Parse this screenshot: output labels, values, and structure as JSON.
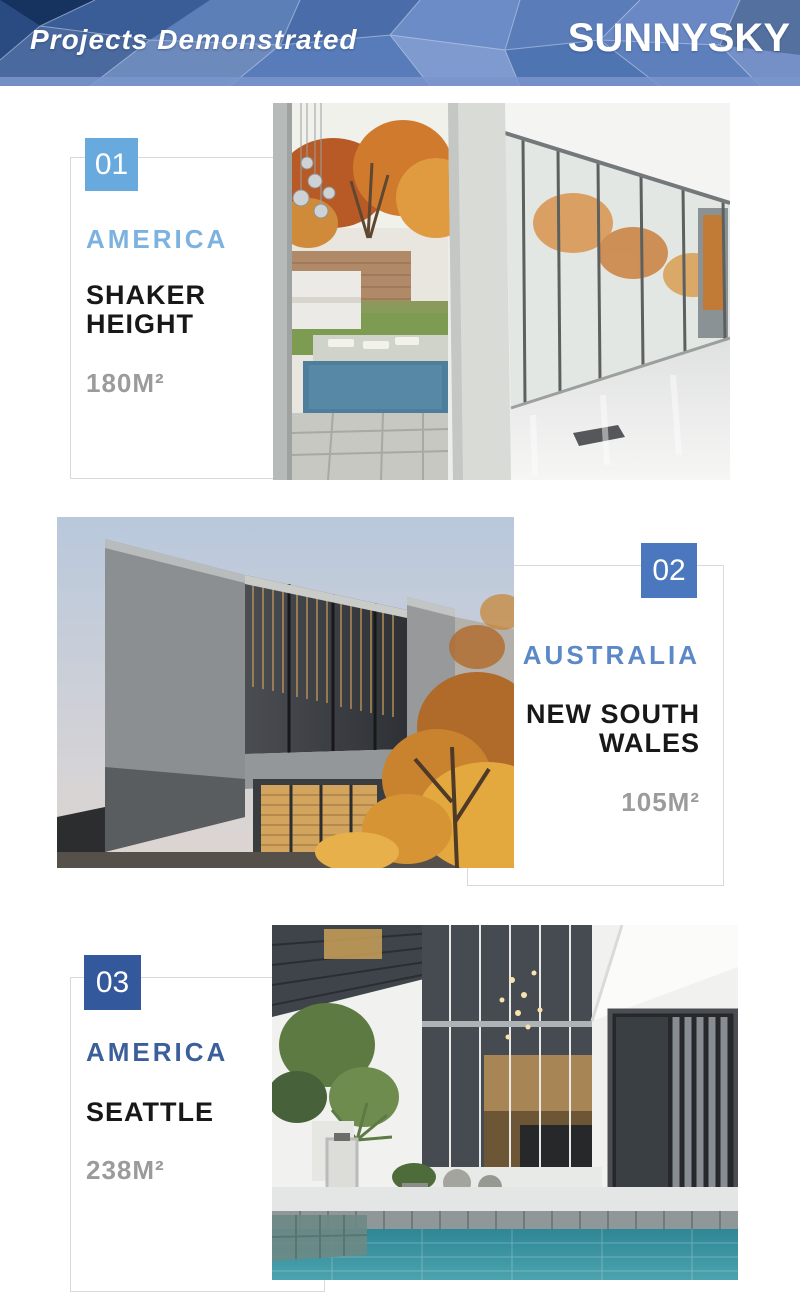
{
  "header": {
    "title": "Projects Demonstrated",
    "brand": "SUNNYSKY"
  },
  "projects": [
    {
      "number": "01",
      "country": "AMERICA",
      "location": "SHAKER HEIGHT",
      "area": "180M²",
      "badge_color": "#68aade",
      "country_color": "#7cb2df",
      "photo": "glass-house-autumn-corridor-photo"
    },
    {
      "number": "02",
      "country": "AUSTRALIA",
      "location": "NEW SOUTH WALES",
      "area": "105M²",
      "badge_color": "#4a77bd",
      "country_color": "#5b88c6",
      "photo": "modern-house-dusk-photo"
    },
    {
      "number": "03",
      "country": "AMERICA",
      "location": "SEATTLE",
      "area": "238M²",
      "badge_color": "#33589b",
      "country_color": "#3b5f9a",
      "photo": "courtyard-pool-house-photo"
    }
  ],
  "styles": {
    "outline_color": "#d9d9d9",
    "location_color": "#181818",
    "area_color": "#9b9b9b",
    "header_base_blue": "#5579b9",
    "header_dark_blue": "#16335f"
  }
}
